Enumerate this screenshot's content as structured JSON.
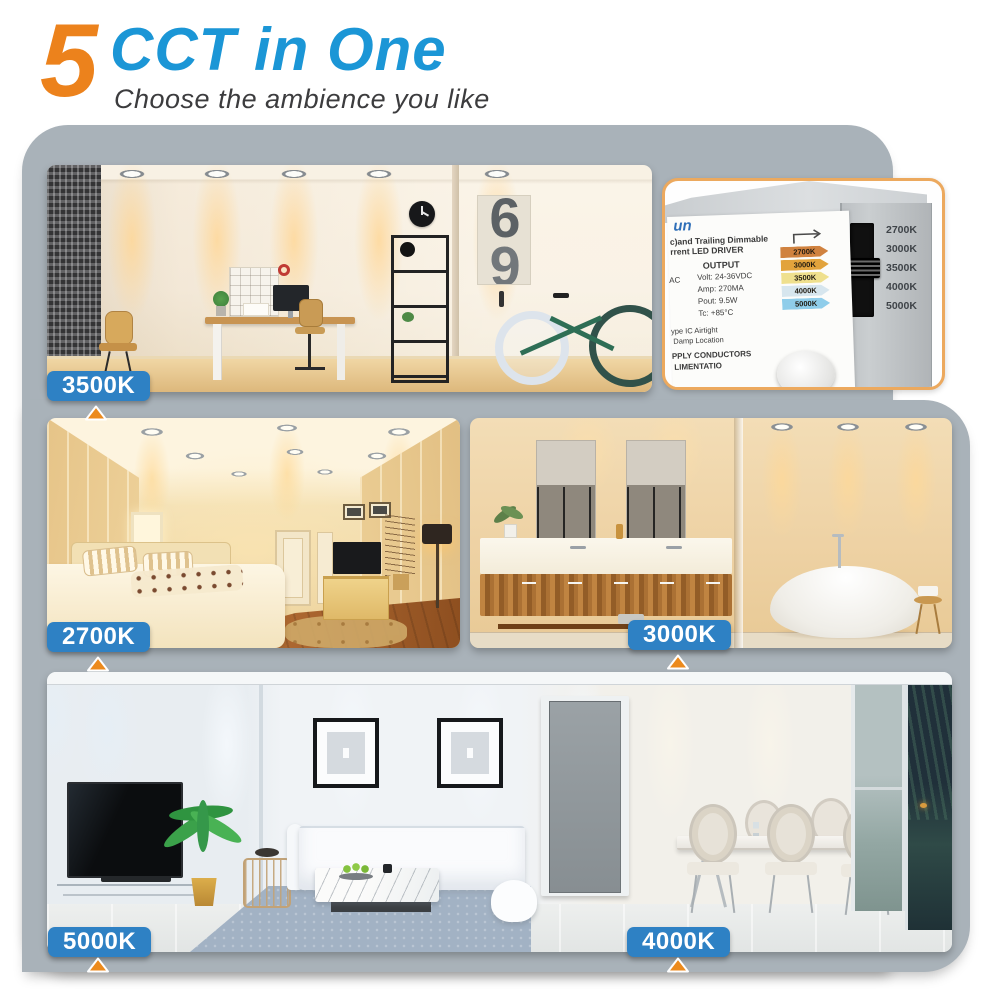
{
  "header": {
    "number": "5",
    "title": "CCT in One",
    "subtitle": "Choose the ambience you like"
  },
  "colors": {
    "accent_orange": "#EC821C",
    "title_blue": "#1B96D6",
    "label_blue": "#2E81C4",
    "panel_gray": "#A9B2B9",
    "inset_border": "#ECA95E"
  },
  "scenes": [
    {
      "name": "home-office",
      "cct": "3500K",
      "poster_digit": "6"
    },
    {
      "name": "bedroom",
      "cct": "2700K"
    },
    {
      "name": "bathroom",
      "cct": "3000K"
    },
    {
      "name": "living-room",
      "cct": "5000K"
    },
    {
      "name": "dining-room",
      "cct": "4000K"
    }
  ],
  "driver_inset": {
    "logo_partial": "un",
    "title_line1": "c)and Trailing Dimmable",
    "title_line2": "rrent LED DRIVER",
    "output_label": "OUTPUT",
    "input_partial": "AC",
    "specs": [
      "Volt: 24-36VDC",
      "Amp: 270MA",
      "Pout: 9.5W",
      "Tc: +85°C"
    ],
    "cct_tags": [
      {
        "label": "2700K",
        "bg": "#D0823F"
      },
      {
        "label": "3000K",
        "bg": "#E2A33C"
      },
      {
        "label": "3500K",
        "bg": "#EFE08E"
      },
      {
        "label": "4000K",
        "bg": "#D7E6EE"
      },
      {
        "label": "5000K",
        "bg": "#8FCDEA"
      }
    ],
    "notes": [
      "ype IC Airtight",
      "Damp Location",
      "PPLY CONDUCTORS",
      "LIMENTATIO"
    ],
    "switch": {
      "labels": [
        "2700K",
        "3000K",
        "3500K",
        "4000K",
        "5000K"
      ],
      "selected": "3500K"
    }
  }
}
